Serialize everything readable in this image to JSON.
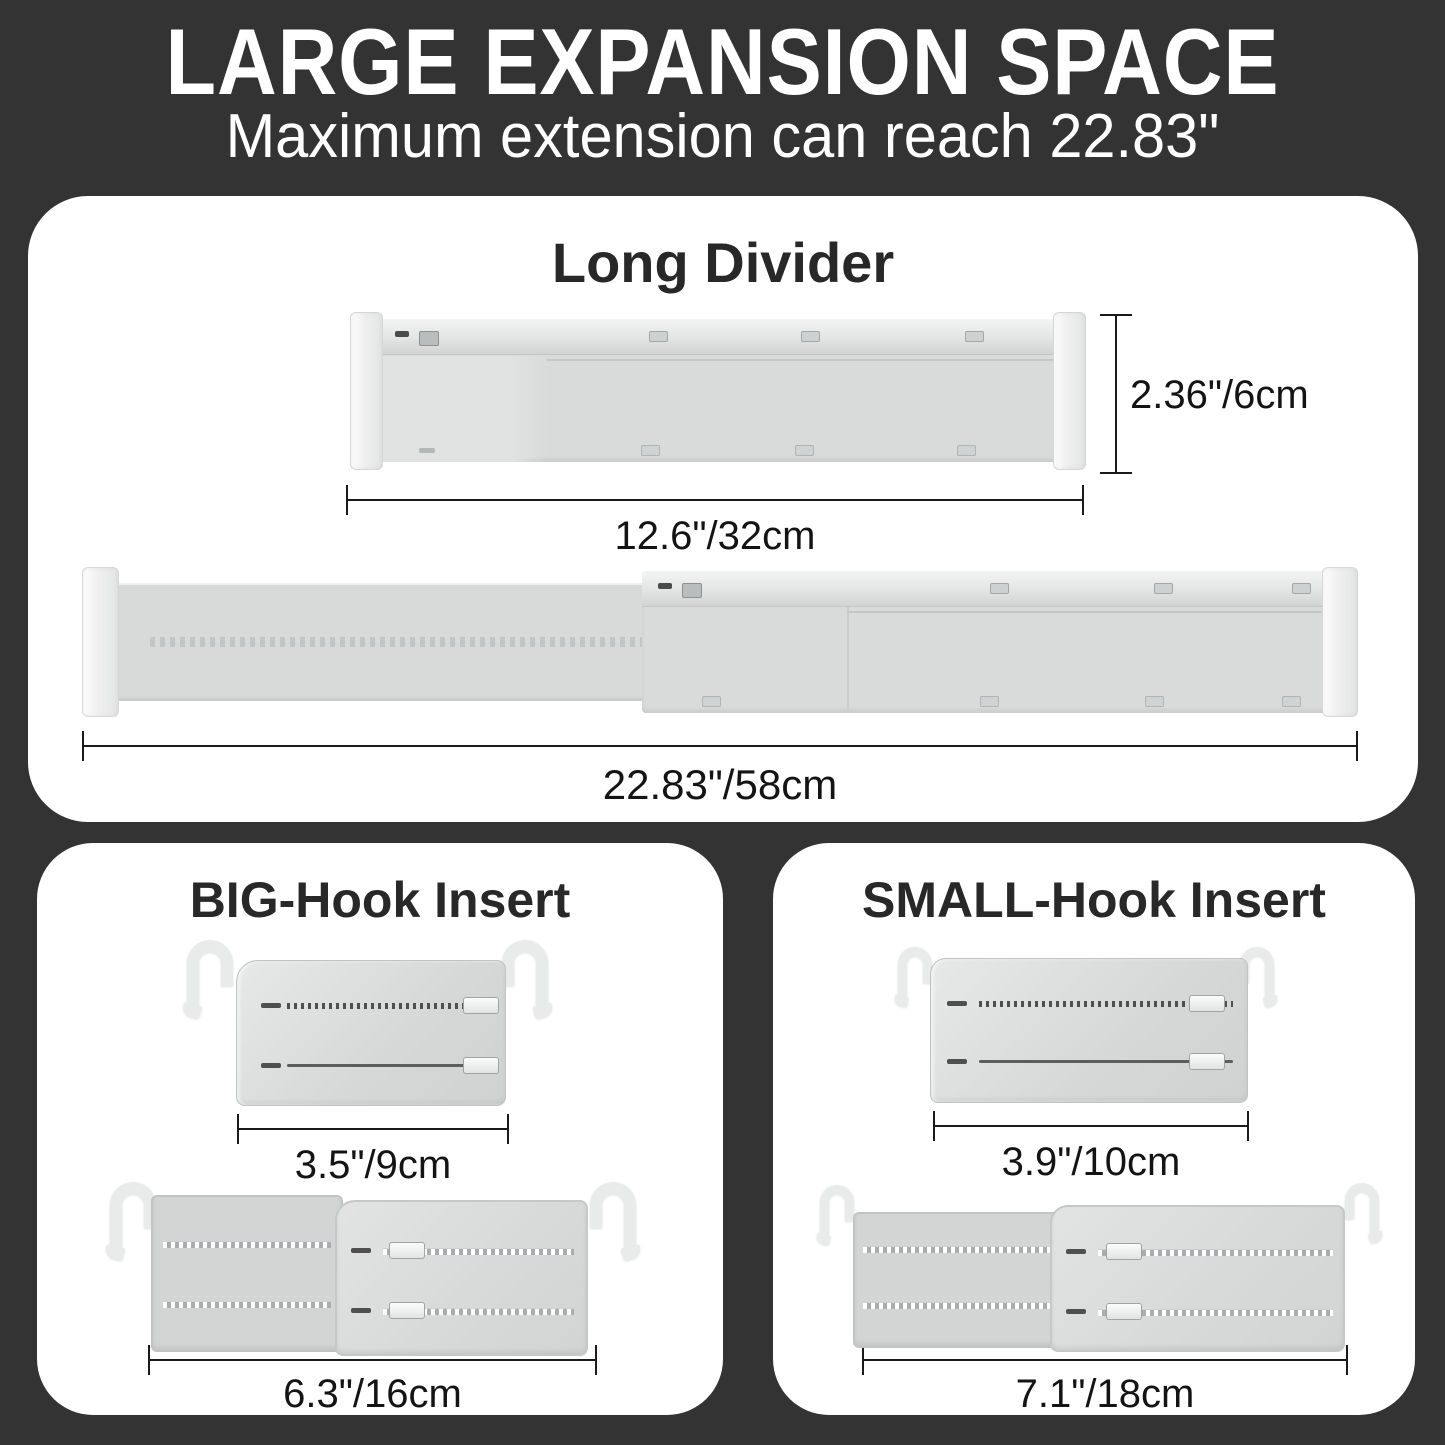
{
  "header": {
    "title": "LARGE EXPANSION SPACE",
    "subtitle": "Maximum extension can reach 22.83\""
  },
  "long_divider": {
    "title": "Long Divider",
    "height_label": "2.36\"/6cm",
    "collapsed_width_label": "12.6\"/32cm",
    "extended_width_label": "22.83\"/58cm"
  },
  "big_hook": {
    "title": "BIG-Hook Insert",
    "collapsed_width_label": "3.5\"/9cm",
    "extended_width_label": "6.3\"/16cm"
  },
  "small_hook": {
    "title": "SMALL-Hook Insert",
    "collapsed_width_label": "3.9\"/10cm",
    "extended_width_label": "7.1\"/18cm"
  },
  "colors": {
    "background": "#333333",
    "panel": "#ffffff",
    "heading_text": "#ffffff",
    "panel_text": "#282828",
    "dimension_text": "#141414",
    "divider_body": "#d9dbdb",
    "end_cap": "#f3f3f3"
  }
}
